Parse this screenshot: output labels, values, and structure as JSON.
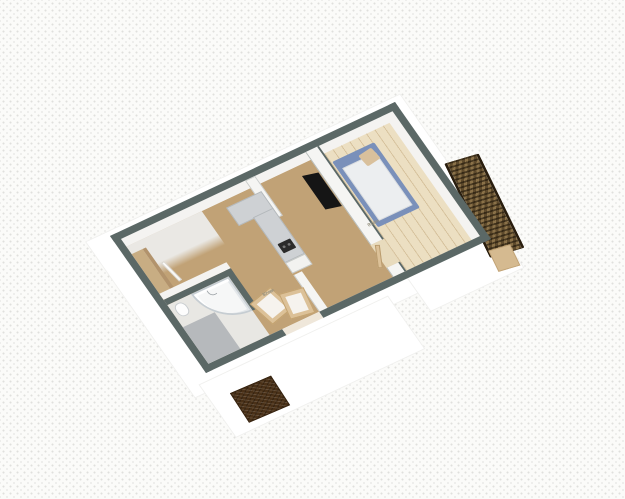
{
  "scene": {
    "name": "3d-floorplan-isometric-view",
    "colors": {
      "bg": "#fbfbf9",
      "wall": "#5b6866",
      "floor-main": "#c1a276",
      "floor-bedroom": "#ecdfc2",
      "bed": "#7a90ba",
      "counter": "#ced1d4",
      "door": "#dcc198",
      "mat": "#4a3118",
      "stairs": "#6a5334"
    }
  },
  "rooms": {
    "bedroom": {
      "label_line1": "Room",
      "label_line2": "9 m²"
    },
    "living": {
      "label_line1": "Room",
      "label_line2": "17 m²"
    }
  },
  "objects": {
    "bed": "double bed with blue frame and pillow",
    "tv": "wall-mounted tv panel",
    "kitchen_counter": "l-shaped counter with cooktop",
    "shower": "quarter-round shower cabin",
    "toilet": "toilet",
    "wardrobe": "wardrobe along hall wall",
    "doormat": "dark woven doormat outside entry",
    "stairs": "woven exterior stair / trellis structure",
    "doors": "open tan door leaves"
  }
}
